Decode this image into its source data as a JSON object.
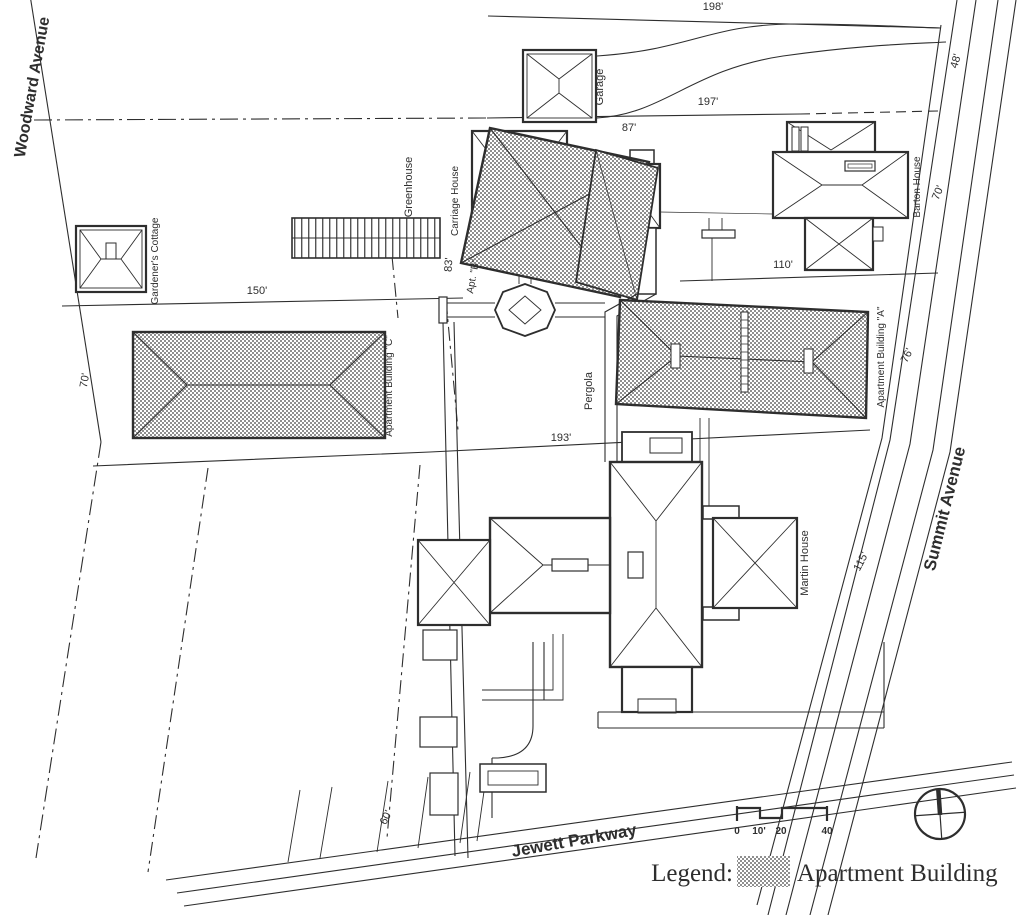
{
  "streets": {
    "woodward": "Woodward Avenue",
    "summit": "Summit Avenue",
    "jewett": "Jewett Parkway"
  },
  "buildings": {
    "garage": "Garage",
    "gardeners_cottage": "Gardener's Cottage",
    "greenhouse": "Greenhouse",
    "carriage_house": "Carriage House",
    "conservatory": "Conservatory",
    "pergola": "Pergola",
    "barton_house": "Barton House",
    "martin_house": "Martin House",
    "apt_a": "Apartment Building \"A\"",
    "apt_b": "Apt. \"B\"",
    "apt_c": "Apartment Building \"C\""
  },
  "dimensions": {
    "d198": "198'",
    "d48": "48'",
    "d197": "197'",
    "d87": "87'",
    "d83": "83'",
    "d110": "110'",
    "d150": "150'",
    "d70_west": "70'",
    "d70_east": "70'",
    "d193": "193'",
    "d76": "76'",
    "d115": "115'",
    "d60": "60'"
  },
  "scale_bar": {
    "ticks": [
      "0",
      "10'",
      "20",
      "40"
    ]
  },
  "legend": {
    "title": "Legend:",
    "item": "Apartment Building"
  },
  "north_arrow": {
    "meaning": "north"
  },
  "colors": {
    "ink": "#2e2e2e",
    "hatch": "#8f8f8f",
    "paper": "#ffffff"
  }
}
